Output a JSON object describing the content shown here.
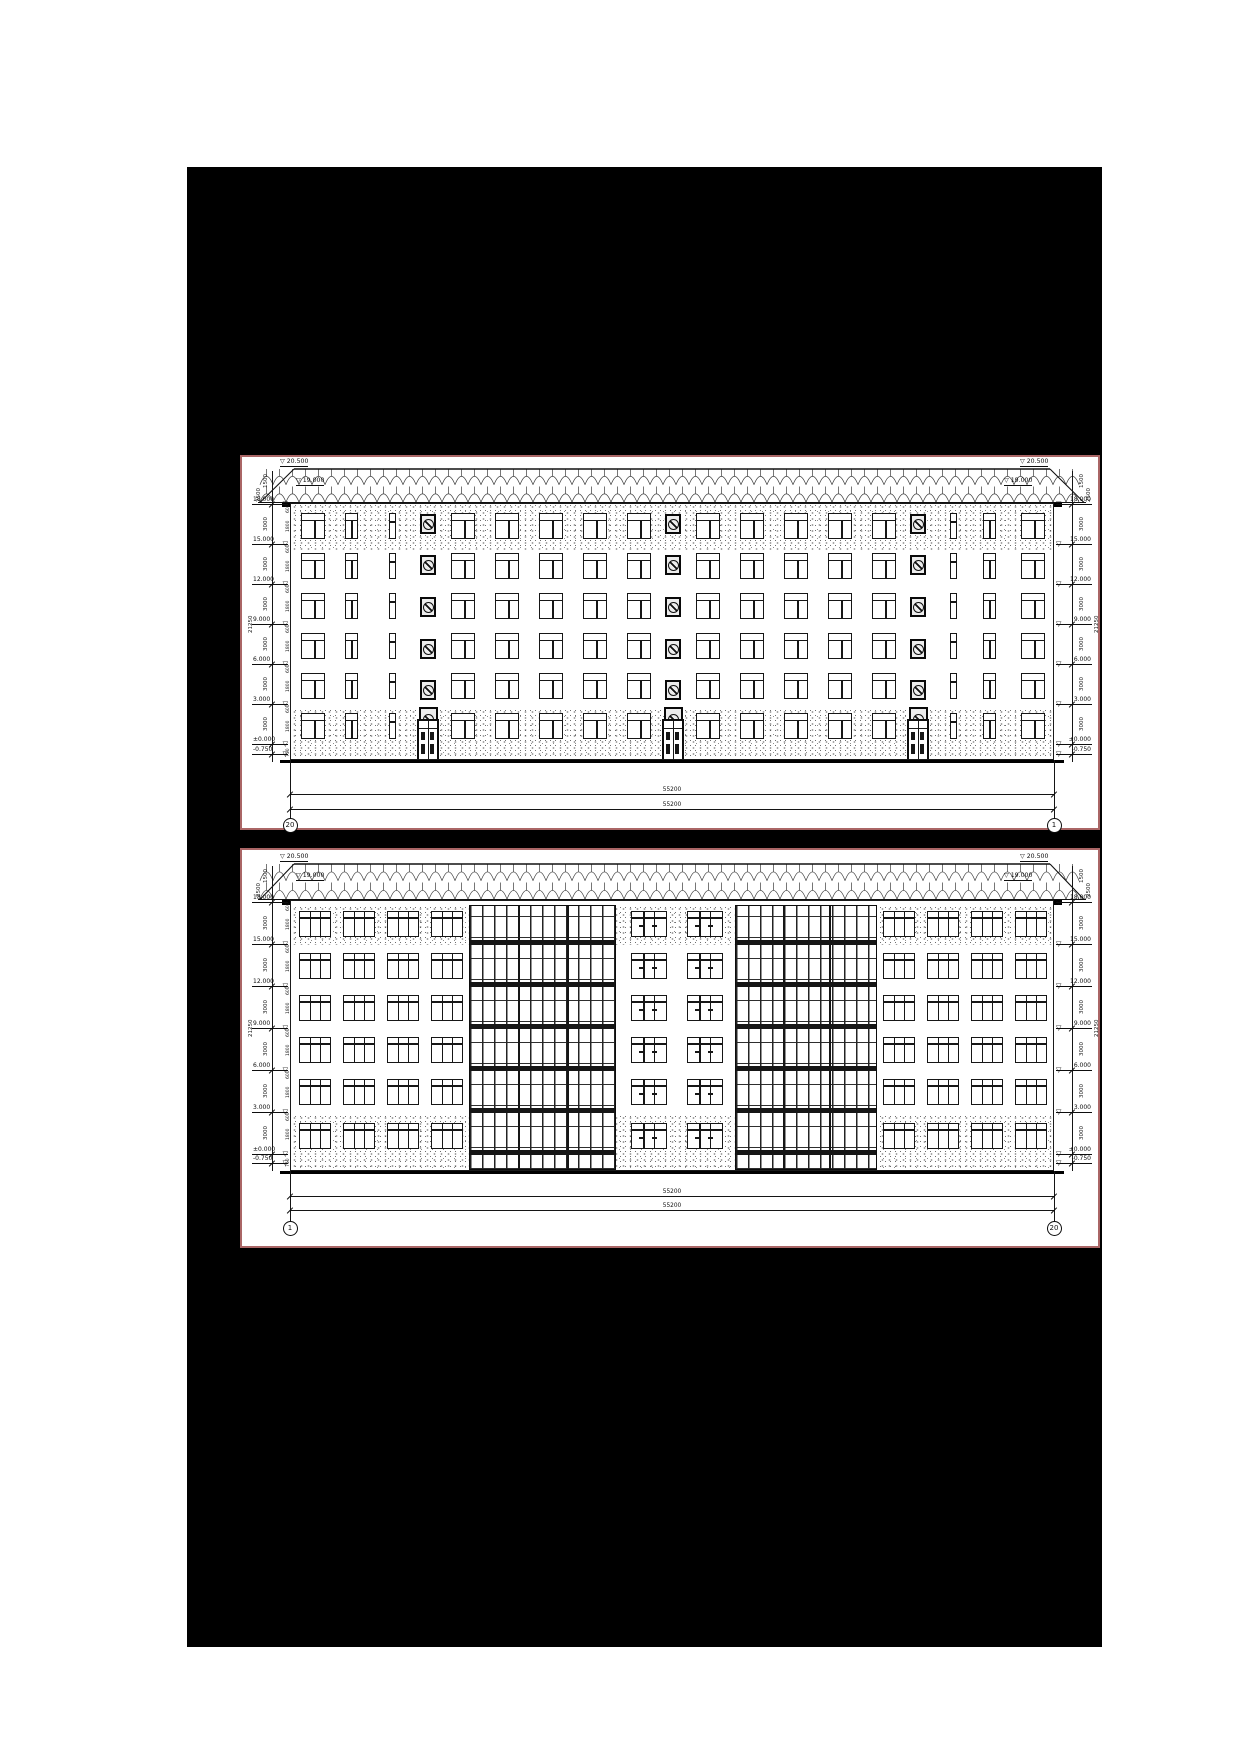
{
  "sheet": {
    "page_bg": "#ffffff",
    "canvas_bg": "#000000",
    "panel_border": "#aa6666",
    "ink": "#141414"
  },
  "panels": [
    {
      "id": "front-elevation",
      "axis_left": "20",
      "axis_right": "1",
      "ridge_level": "20.500",
      "eaves_level": "19.000",
      "levels": [
        "18.000",
        "15.000",
        "12.000",
        "9.000",
        "6.000",
        "3.000",
        "±0.000",
        "-0.750"
      ],
      "top_dims": [
        "1500",
        "2500"
      ],
      "floor_dim": "3000",
      "window_dims": [
        "600",
        "1800"
      ],
      "base_dim": "750",
      "total_dim": "21250",
      "overall_dims": [
        "55200",
        "55200"
      ],
      "geom": {
        "box": {
          "l": 53,
          "t": 288,
          "w": 860,
          "h": 375
        },
        "roof": {
          "x0": 16,
          "x1": 844,
          "ridgeY": 11,
          "eavesY": 46
        },
        "wall": {
          "left": 48,
          "right": 812,
          "top": 46,
          "bottom": 303
        },
        "stipple": [
          {
            "y0": 46,
            "y1": 92
          },
          {
            "y0": 251,
            "y1": 303
          }
        ],
        "rows": [
          55,
          95,
          135,
          175,
          215,
          255
        ],
        "winH": 26,
        "bays": [
          {
            "x": 10,
            "w": 24,
            "t": 1
          },
          {
            "x": 54,
            "w": 13,
            "t": 2
          },
          {
            "x": 98,
            "w": 7,
            "t": 3
          },
          {
            "x": 160,
            "w": 24,
            "t": 1
          },
          {
            "x": 204,
            "w": 24,
            "t": 1
          },
          {
            "x": 248,
            "w": 24,
            "t": 1
          },
          {
            "x": 292,
            "w": 24,
            "t": 1
          },
          {
            "x": 336,
            "w": 24,
            "t": 1
          },
          {
            "x": 405,
            "w": 24,
            "t": 1
          },
          {
            "x": 449,
            "w": 24,
            "t": 1
          },
          {
            "x": 493,
            "w": 24,
            "t": 1
          },
          {
            "x": 537,
            "w": 24,
            "t": 1
          },
          {
            "x": 581,
            "w": 24,
            "t": 1
          },
          {
            "x": 659,
            "w": 7,
            "t": 3
          },
          {
            "x": 692,
            "w": 13,
            "t": 2
          },
          {
            "x": 730,
            "w": 24,
            "t": 1
          }
        ],
        "med_cols": [
          185,
          430,
          675
        ],
        "med_ys": [
          56,
          97,
          139,
          181,
          222
        ],
        "ground_med_y": 249,
        "doors": {
          "centers": [
            185,
            430,
            675
          ],
          "w": 22,
          "h": 42,
          "y": 261
        },
        "levels_y": [
          47,
          87,
          127,
          167,
          207,
          247,
          287,
          297
        ],
        "ann": {
          "leftLineX": 30,
          "rightLineX": 830,
          "innerLeftX": 44
        },
        "bottom": {
          "extTop": 303,
          "extBot": 372,
          "dim1": 337,
          "dim2": 352,
          "circleY": 364
        }
      }
    },
    {
      "id": "rear-elevation",
      "axis_left": "1",
      "axis_right": "20",
      "ridge_level": "20.500",
      "eaves_level": "19.000",
      "levels": [
        "18.000",
        "15.000",
        "12.000",
        "9.000",
        "6.000",
        "3.000",
        "±0.000",
        "-0.750"
      ],
      "top_dims": [
        "1500",
        "2500"
      ],
      "floor_dim": "3000",
      "window_dims": [
        "600",
        "1800"
      ],
      "base_dim": "750",
      "total_dim": "21250",
      "overall_dims": [
        "55200",
        "55200"
      ],
      "geom": {
        "box": {
          "l": 53,
          "t": 681,
          "w": 860,
          "h": 400
        },
        "roof": {
          "x0": 16,
          "x1": 844,
          "ridgeY": 13,
          "eavesY": 50
        },
        "wall": {
          "left": 48,
          "right": 812,
          "top": 50,
          "bottom": 321
        },
        "eavesBarH": 5,
        "stipple": [
          {
            "y0": 55,
            "y1": 94
          },
          {
            "y0": 264,
            "y1": 321
          }
        ],
        "rows": [
          60,
          102,
          144,
          186,
          228,
          272
        ],
        "winH": 26,
        "bays": [
          {
            "x": 8,
            "w": 32,
            "t": 4
          },
          {
            "x": 52,
            "w": 32,
            "t": 4
          },
          {
            "x": 96,
            "w": 32,
            "t": 4
          },
          {
            "x": 140,
            "w": 32,
            "t": 4
          },
          {
            "x": 340,
            "w": 36,
            "t": 5
          },
          {
            "x": 396,
            "w": 36,
            "t": 5
          },
          {
            "x": 592,
            "w": 32,
            "t": 4
          },
          {
            "x": 636,
            "w": 32,
            "t": 4
          },
          {
            "x": 680,
            "w": 32,
            "t": 4
          },
          {
            "x": 724,
            "w": 32,
            "t": 4
          }
        ],
        "glazed": [
          {
            "x": 178,
            "w": 147
          },
          {
            "x": 444,
            "w": 142
          }
        ],
        "slab_ys": [
          88,
          130,
          172,
          214,
          256,
          298
        ],
        "levels_y": [
          52,
          94,
          136,
          178,
          220,
          262,
          304,
          313
        ],
        "ann": {
          "leftLineX": 30,
          "rightLineX": 830,
          "innerLeftX": 44
        },
        "bottom": {
          "extTop": 321,
          "extBot": 380,
          "dim1": 346,
          "dim2": 360,
          "circleY": 374
        }
      }
    }
  ]
}
